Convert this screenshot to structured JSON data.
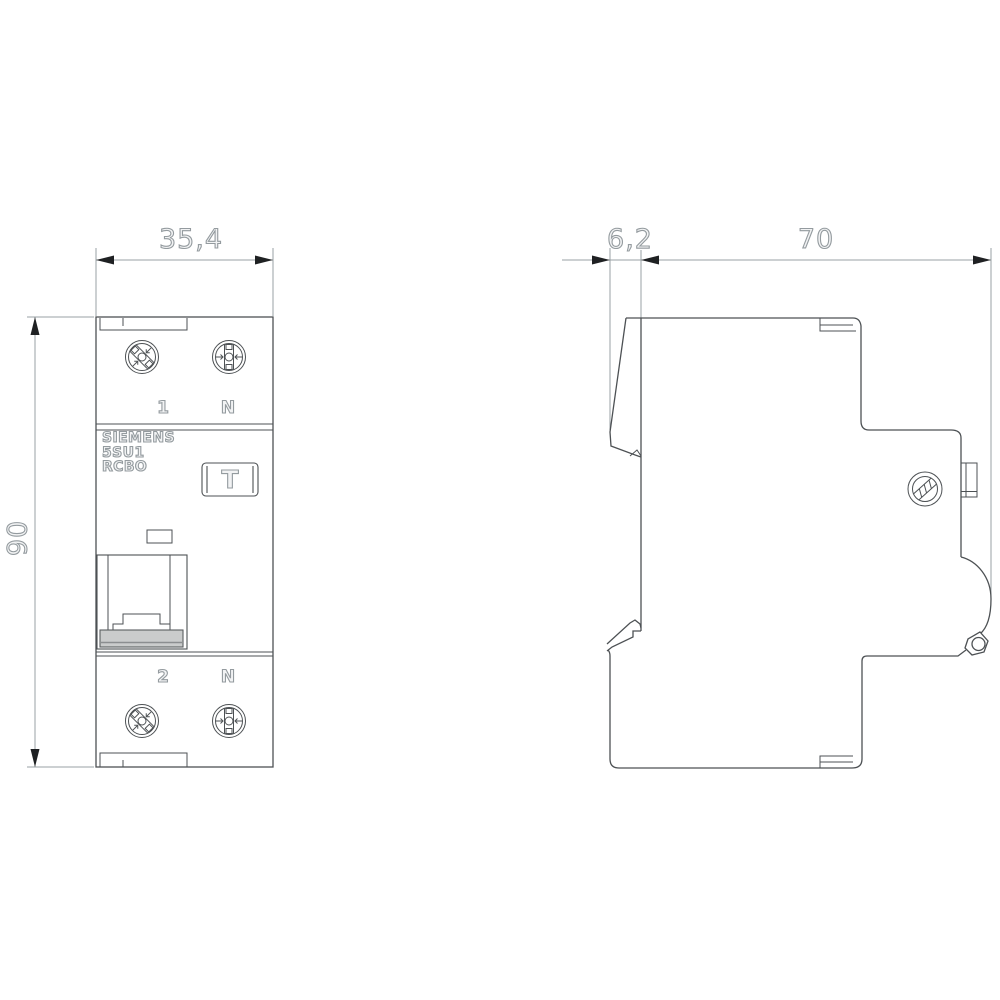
{
  "dimensions_mm": {
    "width": "35,4",
    "height": "90",
    "front_depth": "6,2",
    "body_depth": "70"
  },
  "front_view": {
    "brand": "SIEMENS",
    "model": "5SU1",
    "product_type": "RCBO",
    "test_button_label": "T",
    "terminals": {
      "top_left": "1",
      "top_right": "N",
      "bottom_left": "2",
      "bottom_right": "N"
    }
  },
  "colors": {
    "background": "#ffffff",
    "outline": "#4d5154",
    "dimension": "#9aa0a4",
    "arrow": "#1f2123",
    "toggle_fill": "#cacccc",
    "label_stroke": "#949b9f"
  }
}
